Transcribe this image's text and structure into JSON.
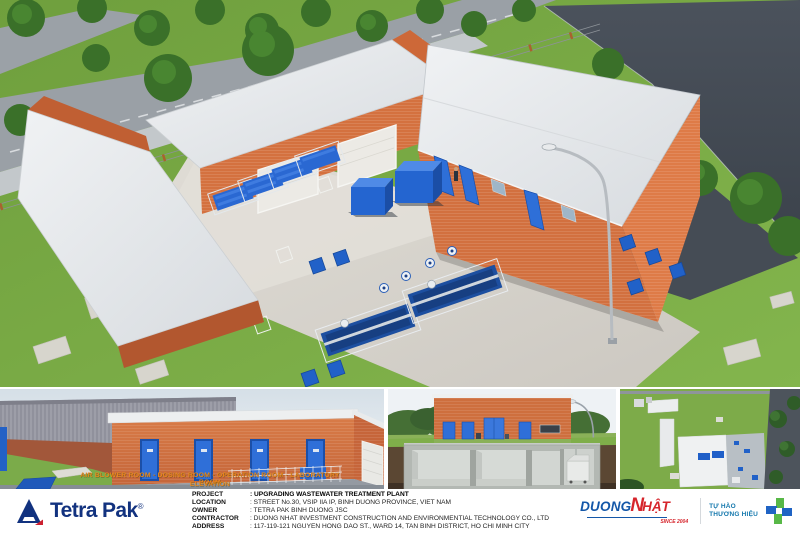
{
  "panels": {
    "elevation_overlay": {
      "line1": "AIR BLOWER ROOM - DOSING ROOM - OPERATION ROOM - LABORATORY ROOM",
      "line2": "ELEVATION"
    }
  },
  "title_block": {
    "brand": {
      "name": "Tetra Pak",
      "registered_mark": "®"
    },
    "project_rows": [
      {
        "label": "PROJECT",
        "value": ": UPGRADING WASTEWATER TREATMENT PLANT"
      },
      {
        "label": "LOCATION",
        "value": ": STREET No.30, VSIP IIA IP, BINH DUONG PROVINCE, VIET NAM"
      },
      {
        "label": "OWNER",
        "value": ": TETRA PAK BINH DUONG JSC"
      },
      {
        "label": "CONTRACTOR",
        "value": ": DUONG NHAT INVESTMENT CONSTRUCTION AND ENVIRONMENTIAL TECHNOLOGY CO., LTD"
      },
      {
        "label": "ADDRESS",
        "value": ": 117-119-121 NGUYEN HONG DAO ST., WARD 14, TAN BINH DISTRICT, HO CHI MINH CITY"
      }
    ],
    "contractor_logo": {
      "word1": "DUONG",
      "word2": "N",
      "word3": "HẬT",
      "since": "SINCE 2004"
    },
    "pride_logo": {
      "line1": "TỰ HÀO",
      "line2": "THƯƠNG HIỆU"
    }
  },
  "colors": {
    "tetra_pak_blue": "#12327f",
    "brick_orange": "#d0703f",
    "equipment_blue": "#2e6fd8",
    "grass_green": "#7cab47",
    "asphalt_dark": "#454c55",
    "duong_nhat_blue": "#1457a8",
    "duong_nhat_red": "#d6252c",
    "pride_blue": "#1478ad",
    "pride_green": "#58b847"
  }
}
